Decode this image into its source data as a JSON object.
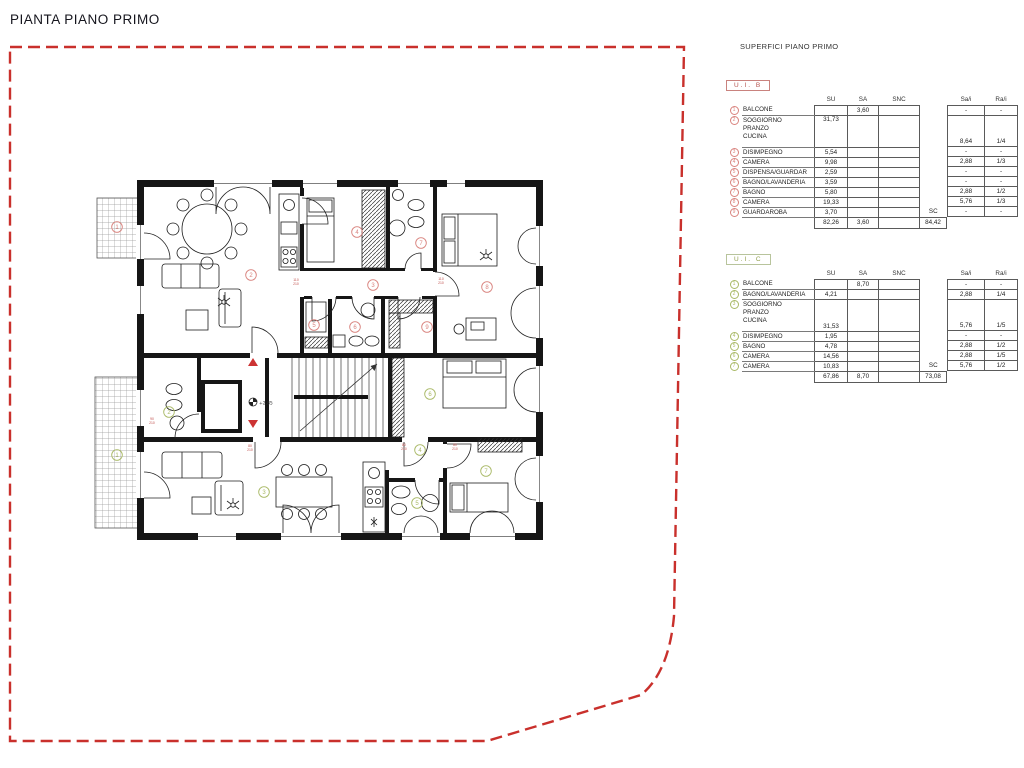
{
  "title": "PIANTA PIANO PRIMO",
  "legend_title": "SUPERFICI PIANO PRIMO",
  "col_headers": {
    "su": "SU",
    "sa": "SA",
    "snc": "SNC",
    "sc": "SC",
    "sai": "Sa/i",
    "rai": "Ra/i"
  },
  "units": [
    {
      "id": "B",
      "label": "U.I.  B",
      "box_border": "#c9827e",
      "text_color": "#b5534f",
      "circle_color": "#d9837e",
      "rows": [
        {
          "n": "1",
          "name": "BALCONE",
          "sa": "3,60",
          "sai": "-",
          "rai": "-"
        },
        {
          "n": "2",
          "name": "SOGGIORNO\nPRANZO\nCUCINA",
          "su": "31,73",
          "su_pos": "top",
          "sai": "8,64",
          "rai": "1/4"
        },
        {
          "n": "3",
          "name": "DISIMPEGNO",
          "su": "5,54",
          "sai": "-",
          "rai": "-"
        },
        {
          "n": "4",
          "name": "CAMERA",
          "su": "9,98",
          "sai": "2,88",
          "rai": "1/3"
        },
        {
          "n": "5",
          "name": "DISPENSA/GUARDAR",
          "su": "2,59",
          "sai": "-",
          "rai": "-"
        },
        {
          "n": "6",
          "name": "BAGNO/LAVANDERIA",
          "su": "3,59",
          "sai": "-",
          "rai": "-"
        },
        {
          "n": "7",
          "name": "BAGNO",
          "su": "5,80",
          "sai": "2,88",
          "rai": "1/2"
        },
        {
          "n": "8",
          "name": "CAMERA",
          "su": "19,33",
          "sai": "5,76",
          "rai": "1/3"
        },
        {
          "n": "9",
          "name": "GUARDAROBA",
          "su": "3,70",
          "sc": "SC",
          "sai": "-",
          "rai": "-"
        }
      ],
      "totals": {
        "su": "82,26",
        "sa": "3,60",
        "sc": "84,42"
      }
    },
    {
      "id": "C",
      "label": "U.I.  C",
      "box_border": "#b8c49c",
      "text_color": "#8f9e4b",
      "circle_color": "#a9b966",
      "rows": [
        {
          "n": "1",
          "name": "BALCONE",
          "sa": "8,70",
          "sai": "-",
          "rai": "-"
        },
        {
          "n": "2",
          "name": "BAGNO/LAVANDERIA",
          "su": "4,21",
          "sai": "2,88",
          "rai": "1/4"
        },
        {
          "n": "3",
          "name": "SOGGIORNO\nPRANZO\nCUCINA",
          "su": "31,53",
          "sai": "5,76",
          "rai": "1/5"
        },
        {
          "n": "4",
          "name": "DISIMPEGNO",
          "su": "1,95",
          "sai": "-",
          "rai": "-"
        },
        {
          "n": "5",
          "name": "BAGNO",
          "su": "4,78",
          "sai": "2,88",
          "rai": "1/2"
        },
        {
          "n": "6",
          "name": "CAMERA",
          "su": "14,56",
          "sai": "2,88",
          "rai": "1/5"
        },
        {
          "n": "7",
          "name": "CAMERA",
          "su": "10,83",
          "sc": "SC",
          "sai": "5,76",
          "rai": "1/2"
        }
      ],
      "totals": {
        "su": "67,86",
        "sa": "8,70",
        "sc": "73,08"
      }
    }
  ],
  "plan": {
    "level_marker": "+2.85",
    "boundary_color": "#c9302c",
    "arrow_color": "#cc3333",
    "unit_b_marker_color": "#d9837e",
    "unit_c_marker_color": "#a9b966",
    "unit_b_markers": [
      {
        "n": "1",
        "x": 117,
        "y": 227
      },
      {
        "n": "2",
        "x": 251,
        "y": 275
      },
      {
        "n": "3",
        "x": 373,
        "y": 285
      },
      {
        "n": "4",
        "x": 357,
        "y": 232
      },
      {
        "n": "5",
        "x": 314,
        "y": 325
      },
      {
        "n": "6",
        "x": 355,
        "y": 327
      },
      {
        "n": "7",
        "x": 421,
        "y": 243
      },
      {
        "n": "8",
        "x": 487,
        "y": 287
      },
      {
        "n": "9",
        "x": 427,
        "y": 327
      }
    ],
    "unit_c_markers": [
      {
        "n": "1",
        "x": 117,
        "y": 455
      },
      {
        "n": "2",
        "x": 169,
        "y": 412
      },
      {
        "n": "3",
        "x": 264,
        "y": 492
      },
      {
        "n": "4",
        "x": 420,
        "y": 450
      },
      {
        "n": "5",
        "x": 417,
        "y": 503
      },
      {
        "n": "6",
        "x": 430,
        "y": 394
      },
      {
        "n": "7",
        "x": 486,
        "y": 471
      }
    ],
    "door_labels": [
      {
        "text": "80 210",
        "x": 404,
        "y": 446
      },
      {
        "text": "80 210",
        "x": 455,
        "y": 446
      },
      {
        "text": "90 210",
        "x": 152,
        "y": 420
      },
      {
        "text": "80 210",
        "x": 250,
        "y": 447
      },
      {
        "text": "110 210",
        "x": 296,
        "y": 281
      },
      {
        "text": "110 210",
        "x": 441,
        "y": 280
      }
    ]
  }
}
